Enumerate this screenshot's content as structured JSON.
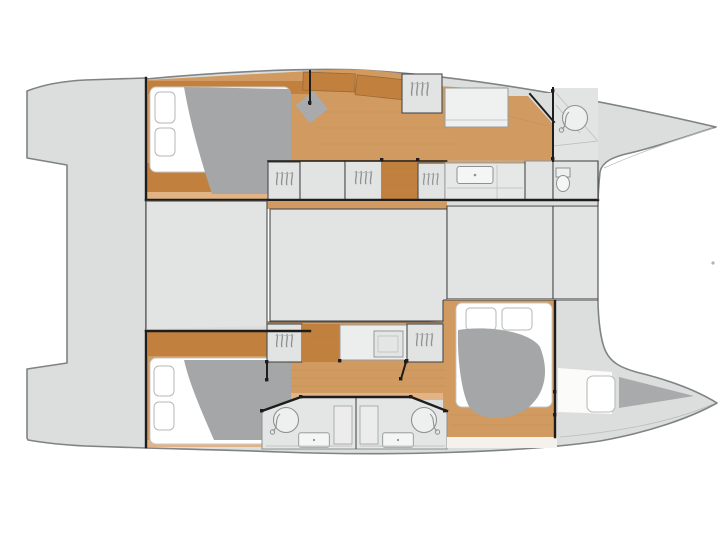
{
  "meta": {
    "diagram_type": "yacht floor plan",
    "subject": "catamaran interior layout, top view, bows pointing right",
    "visible_text": "",
    "hulls": 2,
    "cabins": 3,
    "bathrooms": 3
  },
  "palette": {
    "background": "#ffffff",
    "deck": "#dcdddd",
    "deck_stroke": "#7f8384",
    "box": "#e2e3e3",
    "box_stroke": "#4b4b4a",
    "wood": "#d09a60",
    "wood_dark": "#c2803f",
    "wood_light": "#e2b384",
    "light_strip": "#f5f2ee",
    "mattress": "#ffffff",
    "duvet": "#a4a6a8",
    "wall": "#1d1d1b",
    "fixture": "#8e9192",
    "fixture_fill": "#eef0f0",
    "locker_gray": "#a8aaac",
    "marker": "#b3b3b3"
  },
  "icons": {
    "hanger": "hanging-clothes squiggles in wardrobes",
    "shower": "circle with hand-shower hose",
    "toilet": "tank and bowl",
    "sink": "basin with drain dot",
    "chair": "rotated square office chair",
    "bed": "double berth with gray duvet and two pillows"
  }
}
